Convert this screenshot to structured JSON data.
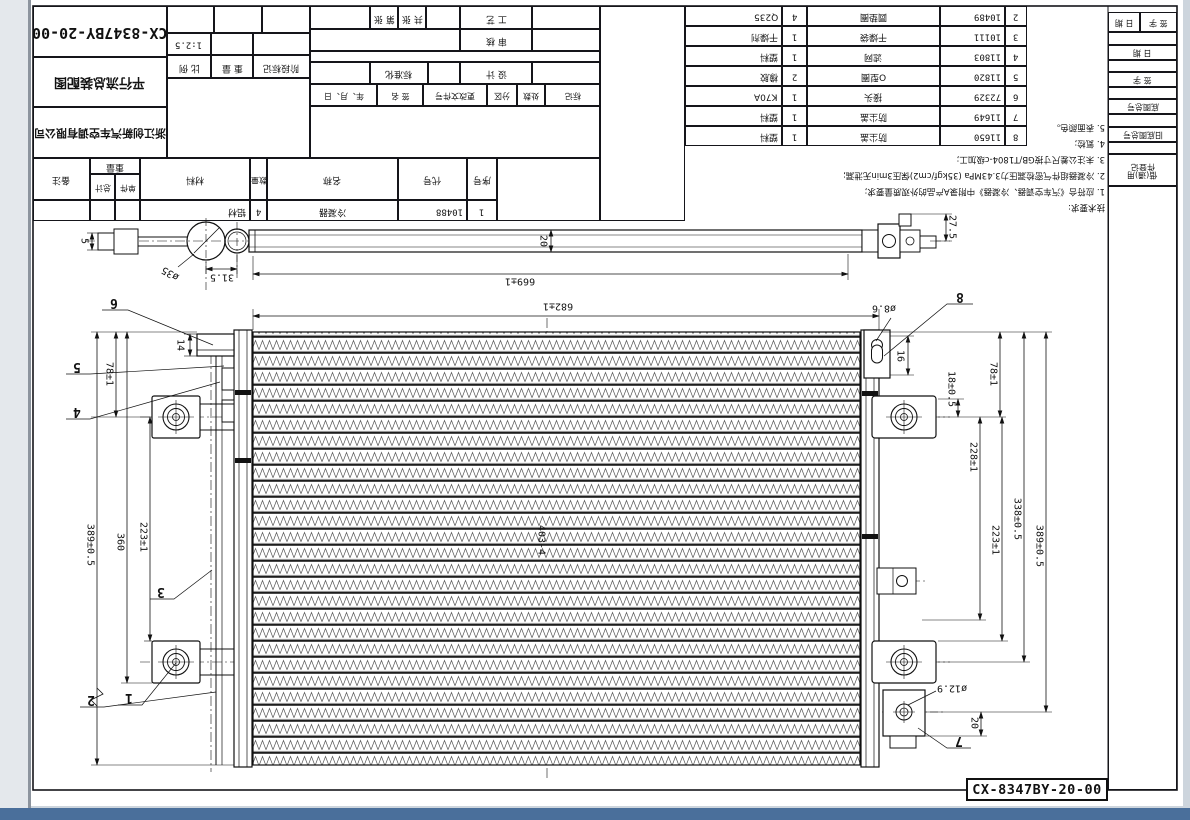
{
  "sheet": {
    "drawing_number": "CX-8347BY-20-00",
    "view_title": "平行流总装配图",
    "company": "浙江创新汽车空调有限公司",
    "part_label": "CX-8347BY-20-00"
  },
  "title_block": {
    "scale_value": "1:2.5",
    "biaoji": "标记",
    "chushu": "处数",
    "fenqu": "分区",
    "genggai": "更改文件号",
    "qianming": "签 名",
    "nianyueri": "年、月、日",
    "sheji": "设 计",
    "biaozhunhua": "标准化",
    "shenhe": "审 核",
    "gongyi": "工 艺",
    "gongzhang": "共 张",
    "dizhang": "第 张",
    "jieduan": "阶段标记",
    "zhongliang": "重 量",
    "bili": "比 例"
  },
  "bom": {
    "h_xuhao": "序号",
    "h_daihao": "代号",
    "h_mingcheng": "名称",
    "h_shuliang": "数量",
    "h_cailiao": "材料",
    "h_zhongliang": "重量",
    "h_danjian": "单件",
    "h_zongji": "总计",
    "h_beizhu": "备注",
    "row1": {
      "seq": "1",
      "code": "10488",
      "name": "冷凝器",
      "qty": "4",
      "material": "铝材"
    },
    "rows": [
      {
        "seq": "2",
        "code": "10489",
        "name": "圆垫圈",
        "qty": "4",
        "material": "Q235"
      },
      {
        "seq": "3",
        "code": "10111",
        "name": "干燥袋",
        "qty": "1",
        "material": "干燥剂"
      },
      {
        "seq": "4",
        "code": "11803",
        "name": "滤网",
        "qty": "1",
        "material": "塑料"
      },
      {
        "seq": "5",
        "code": "11820",
        "name": "O型圈",
        "qty": "2",
        "material": "橡胶"
      },
      {
        "seq": "6",
        "code": "72329",
        "name": "接头",
        "qty": "1",
        "material": "K70A"
      },
      {
        "seq": "7",
        "code": "11649",
        "name": "防尘盖",
        "qty": "1",
        "material": "塑料"
      },
      {
        "seq": "8",
        "code": "11650",
        "name": "防尘盖",
        "qty": "1",
        "material": "塑料"
      }
    ]
  },
  "notes": {
    "title": "技术要求:",
    "n1": "1. 应符合《汽车空调器、冷凝器》中附录A产品的外观质量要求;",
    "n2": "2. 冷凝器组件气密检漏压力3.43MPa (35kgf/cm2)保压3min无泄漏;",
    "n3": "3. 未注公差尺寸按GB/T1804-c级加工;",
    "n4": "4. 氦检;",
    "n5": "5. 表面颜色。"
  },
  "margin": {
    "pair_left": "日 期",
    "pair_right": "签 字",
    "riqi": "日 期",
    "qianzi": "签 字",
    "dituzonghao": "底图总号",
    "jiudituzonghao": "旧底图总号",
    "dengji": "件登记",
    "jieyong": "借(通)用"
  },
  "dims": {
    "d5": "5",
    "d35": "ø35",
    "d315": "31.5",
    "d20top": "20",
    "d669": "669±1",
    "d275": "27.5",
    "d682": "682±1",
    "d86": "ø8.6",
    "d16": "16",
    "d14": "14",
    "d78l": "78±1",
    "d78r": "78±1",
    "d18": "18±0.5",
    "d228": "228±1",
    "d223l": "223±1",
    "d223r": "223±1",
    "d338": "338±0.5",
    "d389l": "389±0.5",
    "d389r": "389±0.5",
    "d360": "360",
    "d403": "403-4",
    "d129": "ø12.9",
    "d20br": "20"
  },
  "balloons": {
    "b1": "1",
    "b2": "2",
    "b3": "3",
    "b4": "4",
    "b5": "5",
    "b6": "6",
    "b7": "7",
    "b8": "8"
  }
}
